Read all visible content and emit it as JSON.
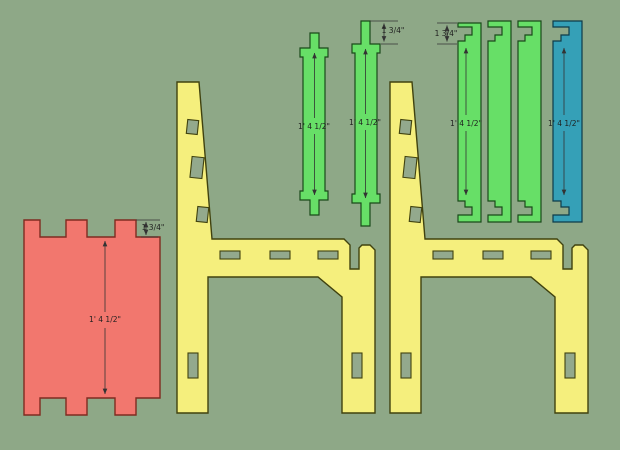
{
  "scene": {
    "background_color": "#8EA887"
  },
  "colors": {
    "panel_fill": "#F2776E",
    "panel_stroke": "#7F2B20",
    "side_fill": "#F5EF7D",
    "side_stroke": "#40420F",
    "slat_fill": "#67DF67",
    "slat_stroke": "#1A4A1A",
    "teal_fill": "#35A0B7",
    "teal_stroke": "#0D3B4A",
    "hole_fill": "#93A98D",
    "dimension_color": "#333333"
  },
  "dimensions": {
    "long_label": "1' 4 1/2\"",
    "short_label": "1 3/4\""
  }
}
